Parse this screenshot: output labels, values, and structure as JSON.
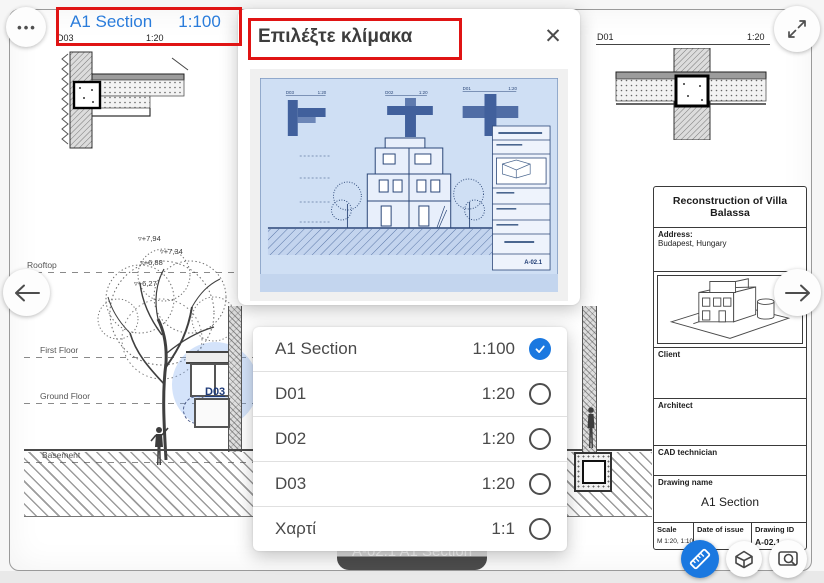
{
  "header": {
    "more_icon": "•••",
    "scale_button": {
      "name": "A1 Section",
      "scale": "1:100"
    }
  },
  "modal": {
    "title": "Επιλέξτε κλίμακα",
    "close_icon": "✕",
    "options": [
      {
        "label": "A1 Section",
        "scale": "1:100",
        "selected": true
      },
      {
        "label": "D01",
        "scale": "1:20",
        "selected": false
      },
      {
        "label": "D02",
        "scale": "1:20",
        "selected": false
      },
      {
        "label": "D03",
        "scale": "1:20",
        "selected": false
      },
      {
        "label": "Χαρτί",
        "scale": "1:1",
        "selected": false
      }
    ]
  },
  "preview": {
    "details": [
      {
        "id": "D03",
        "scale": "1:20"
      },
      {
        "id": "D02",
        "scale": "1:20"
      },
      {
        "id": "D01",
        "scale": "1:20"
      }
    ],
    "drawing_id": "A-02.1"
  },
  "drawing": {
    "detail_left": {
      "id": "D03",
      "scale": "1:20"
    },
    "detail_right": {
      "id": "D01",
      "scale": "1:20"
    },
    "floors": {
      "rooftop": "Rooftop",
      "first": "First Floor",
      "ground": "Ground Floor",
      "basement": "Basement"
    },
    "elevations": [
      "▿+7,94",
      "▿+7,34",
      "▿+6,88",
      "▿+6,27"
    ],
    "marker": "D03",
    "title_block": {
      "project": "Reconstruction of Villa Balassa",
      "address_label": "Address:",
      "address": "Budapest, Hungary",
      "client": "Client",
      "architect": "Architect",
      "cad": "CAD technician",
      "drawing_name_label": "Drawing name",
      "drawing_name": "A1 Section",
      "scale_label": "Scale",
      "scale_value": "M 1:20, 1:100",
      "date_label": "Date of issue",
      "id_label": "Drawing ID",
      "id_value": "A-02.1"
    }
  },
  "toast": "A-02.1 A1 Section",
  "colors": {
    "accent": "#1a78e0",
    "annotation": "#e01414",
    "link": "#2a7cdb",
    "toast": "#4a4a4a"
  }
}
